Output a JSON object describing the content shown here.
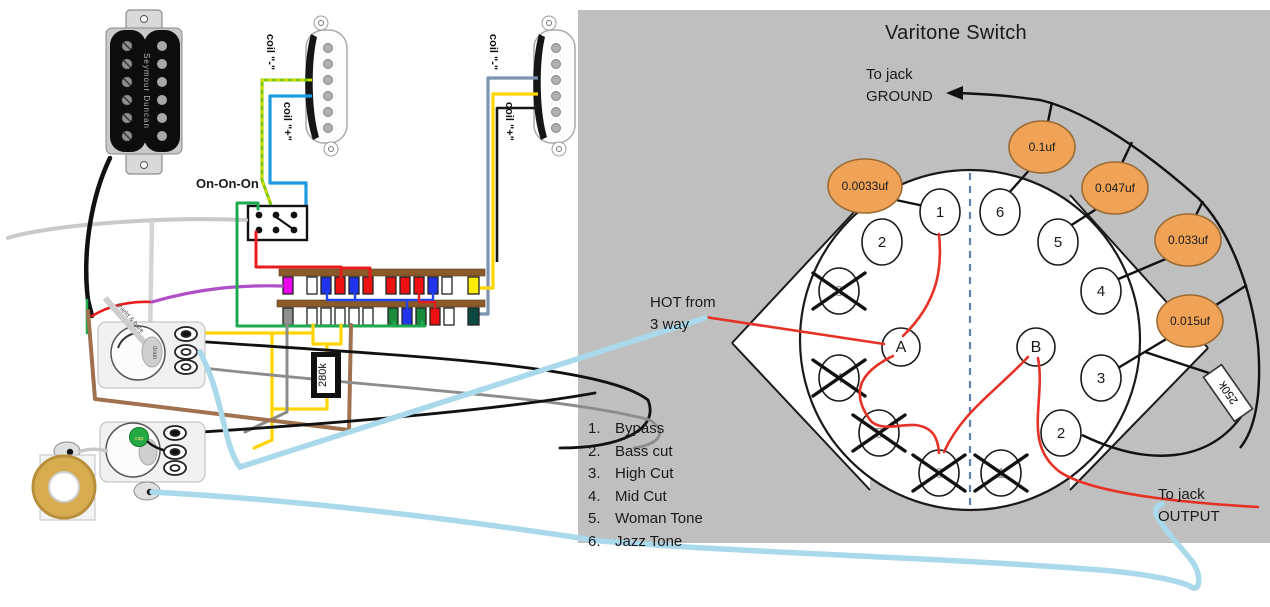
{
  "colors": {
    "panel": "#bfbfbf",
    "cap_fill": "#f0a357",
    "cap_stroke": "#9a6a33",
    "red_wire": "#e63226",
    "callout_wire": "#a9d9ea",
    "dash_line": "#5b84b1",
    "superswitch_bar": "#8a5a28"
  },
  "left_diagram": {
    "humbucker_brand": "Seymour Duncan",
    "toggle_label": "On-On-On",
    "coil_minus_label": "coil \"-\"",
    "coil_plus_label": "coil \"+\"",
    "resistor_label": "280k",
    "tone_cap_label": "cap",
    "shield_label": "shield & bare",
    "pot_shaft_label": "drain",
    "superswitch": {
      "top_row": [
        "#ee00ee",
        "#ffffff",
        "#2233ee",
        "#ee1111",
        "#2233ee",
        "#ee1111",
        "#ee1111",
        "#ee1111",
        "#ee1111",
        "#2233ee",
        "#ffffff",
        "#ffee00"
      ],
      "bottom_row": [
        "#909090",
        "#ffffff",
        "#ffffff",
        "#ffffff",
        "#ffffff",
        "#ffffff",
        "#1a8a3a",
        "#2233ee",
        "#1a8a3a",
        "#ee1111",
        "#ffffff",
        "#0a4a40"
      ]
    }
  },
  "varitone": {
    "title": "Varitone Switch",
    "ground_label_line1": "To jack",
    "ground_label_line2": "GROUND",
    "output_label_line1": "To jack",
    "output_label_line2": "OUTPUT",
    "hot_label_line1": "HOT from",
    "hot_label_line2": "3 way",
    "pole_a": "A",
    "pole_b": "B",
    "resistor_label": "250k",
    "capacitors": [
      "0.0033uf",
      "0.1uf",
      "0.047uf",
      "0.033uf",
      "0.015uf"
    ],
    "left_lugs": [
      "1",
      "2",
      "3",
      "4",
      "5",
      "6"
    ],
    "right_lugs": [
      "6",
      "5",
      "4",
      "3",
      "2",
      "1"
    ],
    "legend": [
      {
        "num": "1.",
        "label": "Bypass"
      },
      {
        "num": "2.",
        "label": "Bass cut"
      },
      {
        "num": "3.",
        "label": "High Cut"
      },
      {
        "num": "4.",
        "label": "Mid Cut"
      },
      {
        "num": "5.",
        "label": "Woman Tone"
      },
      {
        "num": "6.",
        "label": "Jazz Tone"
      }
    ]
  }
}
